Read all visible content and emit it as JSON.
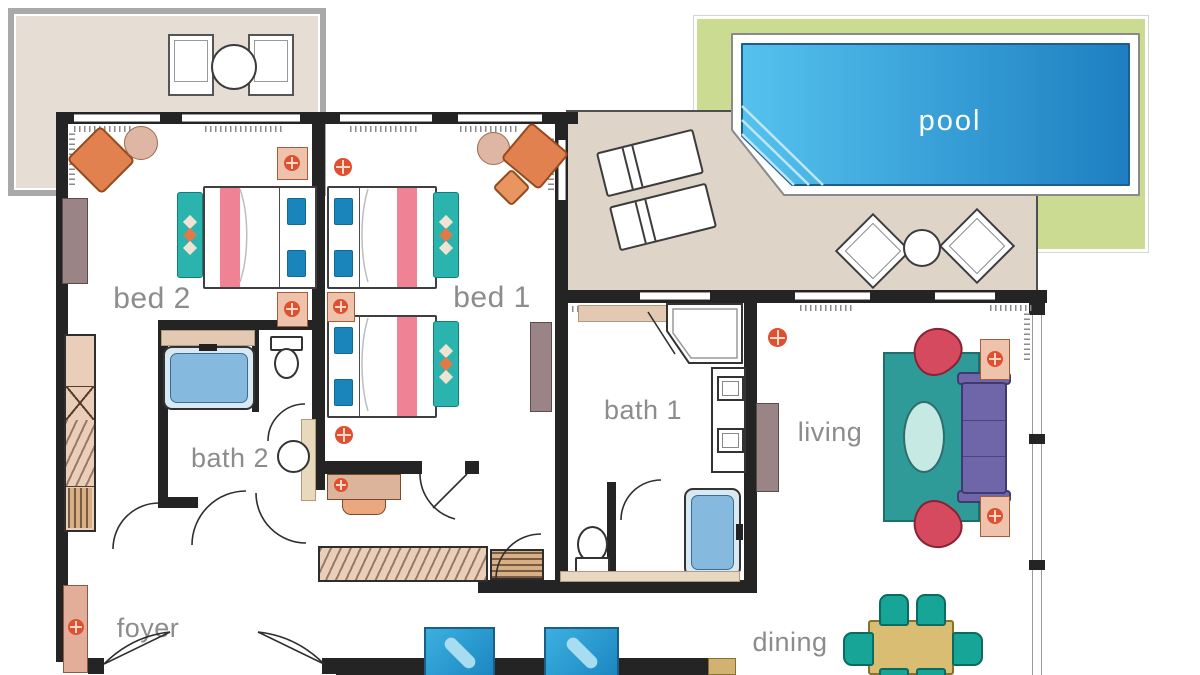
{
  "rooms": {
    "bed2": {
      "label": "bed 2"
    },
    "bed1": {
      "label": "bed 1"
    },
    "bath2": {
      "label": "bath 2"
    },
    "bath1": {
      "label": "bath 1"
    },
    "living": {
      "label": "living"
    },
    "dining": {
      "label": "dining"
    },
    "foyer": {
      "label": "foyer"
    },
    "pool": {
      "label": "pool"
    }
  },
  "colors": {
    "wall": "#242424",
    "room-label": "#8c8c8c",
    "terrace-floor": "#e6ded5",
    "terrace-frame": "#a9a9a9",
    "lawn": "#cbdc92",
    "deck": "#ded4c8",
    "pool-light": "#55c2ee",
    "pool-dark": "#1d7fc1",
    "pool-text": "#ffffff",
    "bed-stripe": "#ef8294",
    "pillow-blue": "#1a85bb",
    "bench-teal": "#2bb3ad",
    "rug-teal": "#2e9b98",
    "sofa-purple": "#6f66aa",
    "armchair-red": "#d54a5e",
    "armchair-orange": "#e0814f",
    "side-table-pink": "#dfb5a3",
    "nightstand-pink": "#eec2ab",
    "flower-red": "#e04f30",
    "counter-tan": "#e3c9b2",
    "tub-blue": "#85bade",
    "dining-table": "#d9bd72",
    "dining-chair": "#16a596",
    "cabinet-mauve": "#9b8486",
    "ottoman-blue-light": "#a8dcf0",
    "closet-wood": "#e9cfba"
  }
}
